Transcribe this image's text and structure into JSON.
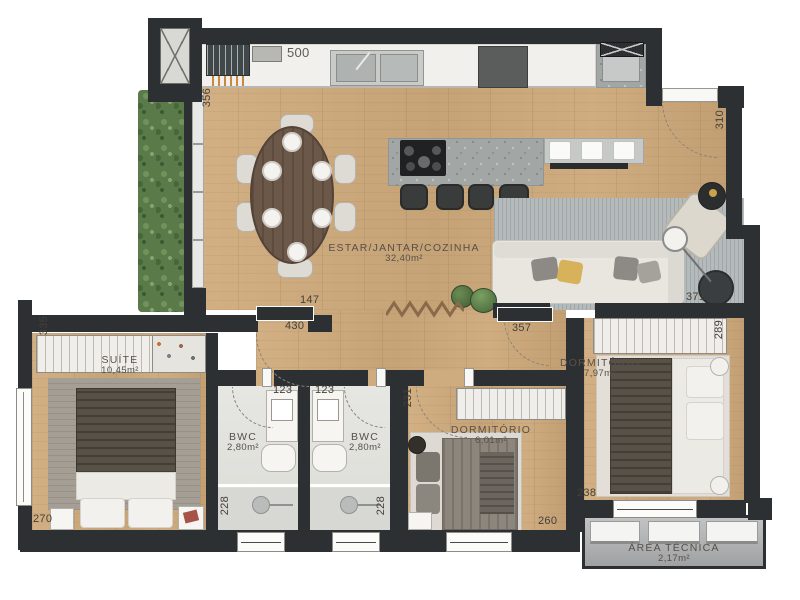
{
  "plan_type": "apartment-floor-plan",
  "rooms": {
    "living": {
      "name": "ESTAR/JANTAR/COZINHA",
      "area": "32,40m²"
    },
    "suite": {
      "name": "SUÍTE",
      "area": "10,45m²"
    },
    "bwc1": {
      "name": "BWC",
      "area": "2,80m²"
    },
    "bwc2": {
      "name": "BWC",
      "area": "2,80m²"
    },
    "dorm1": {
      "name": "DORMITÓRIO",
      "area": "6,01m²"
    },
    "dorm2": {
      "name": "DORMITÓRIO",
      "area": "7,97m²"
    },
    "tech": {
      "name": "ÁREA TÉCNICA",
      "area": "2,17m²"
    }
  },
  "dims": {
    "d500": "500",
    "d356": "356",
    "d310": "310",
    "d371": "371",
    "d147": "147",
    "d430": "430",
    "d357": "357",
    "d335": "335",
    "d270": "270",
    "d123a": "123",
    "d123b": "123",
    "d228a": "228",
    "d228b": "228",
    "d231": "231",
    "d260": "260",
    "d289": "289",
    "d238": "238"
  },
  "colors": {
    "wall": "#2d3032",
    "wood": "#c9a87b",
    "hedge_green": "#5a7a49",
    "rug_gray": "#b5babb",
    "granite": "#a2a7a5",
    "bwc_floor": "#e2e2de",
    "tech_gray": "#b0b2b3",
    "accent_pillow": "#d8b25a"
  }
}
